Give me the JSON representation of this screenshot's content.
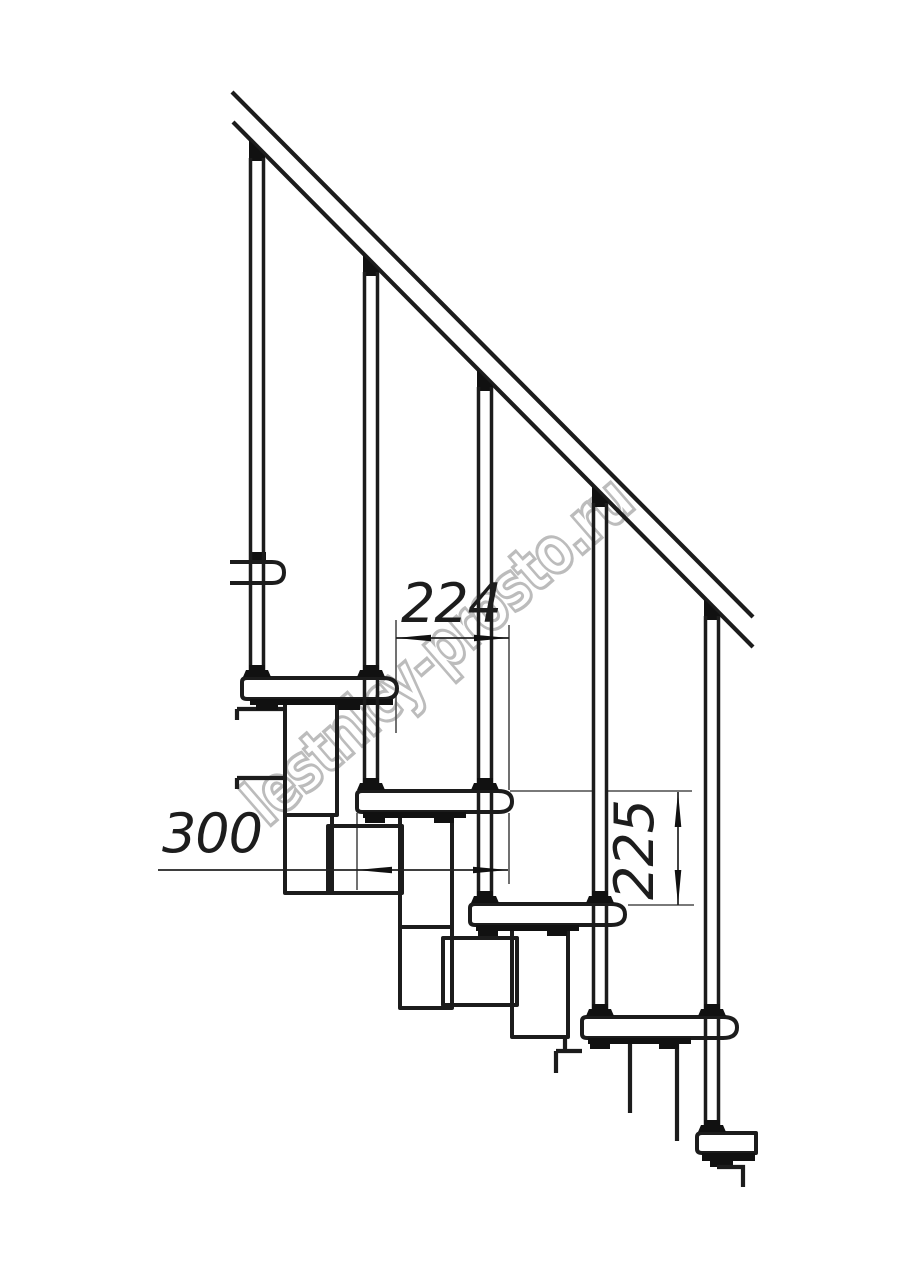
{
  "drawing": {
    "title": "staircase-side-view-technical-drawing",
    "watermark": {
      "text": "lestnicy-prosto.ru",
      "color": "#bcbcbc"
    },
    "line_color": "#1c1c1c",
    "background_color": "#ffffff",
    "dimensions": {
      "run": {
        "value": "224"
      },
      "depth": {
        "value": "300"
      },
      "rise": {
        "value": "225"
      }
    },
    "counts": {
      "balusters": 5,
      "treads": 5
    }
  }
}
